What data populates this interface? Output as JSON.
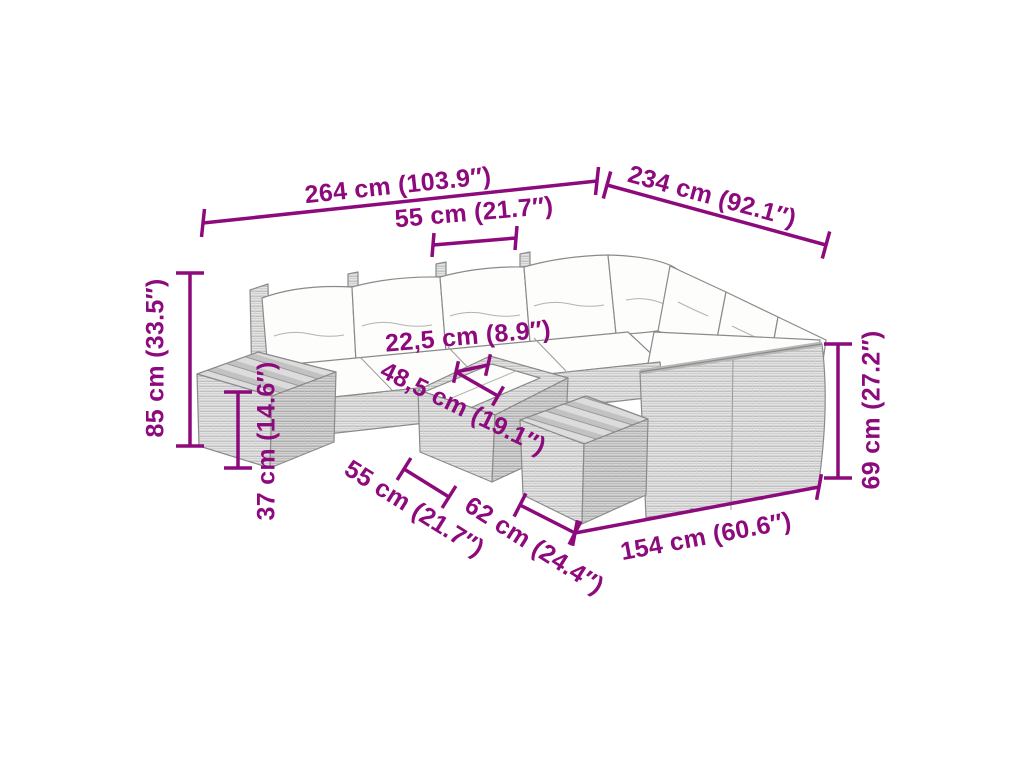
{
  "illustration": {
    "subject": "Modular poly rattan garden lounge set with white cushions, side table with slatted top, coffee table with tray and footstool, drawn as grey line art"
  },
  "colors": {
    "dimension_accent": "#8d0a7d",
    "outline_grey": "#8a8a8a",
    "rattan_light": "#e4e4e4",
    "rattan_dark": "#d4d4d4",
    "cushion_white": "#fdfdfb",
    "background": "#ffffff"
  },
  "dimensions": {
    "overall_width": "264 cm (103.9″)",
    "overall_depth": "234 cm (92.1″)",
    "seat_width": "55 cm (21.7″)",
    "overall_height": "85 cm (33.5″)",
    "side_table_height": "37 cm (14.6″)",
    "tray_width": "22,5 cm (8.9″)",
    "coffee_table_width": "48,5 cm (19.1″)",
    "footstool_width": "55 cm (21.7″)",
    "footstool_depth": "62 cm (24.4″)",
    "right_section_length": "154 cm (60.6″)",
    "backrest_height": "69 cm (27.2″)"
  }
}
